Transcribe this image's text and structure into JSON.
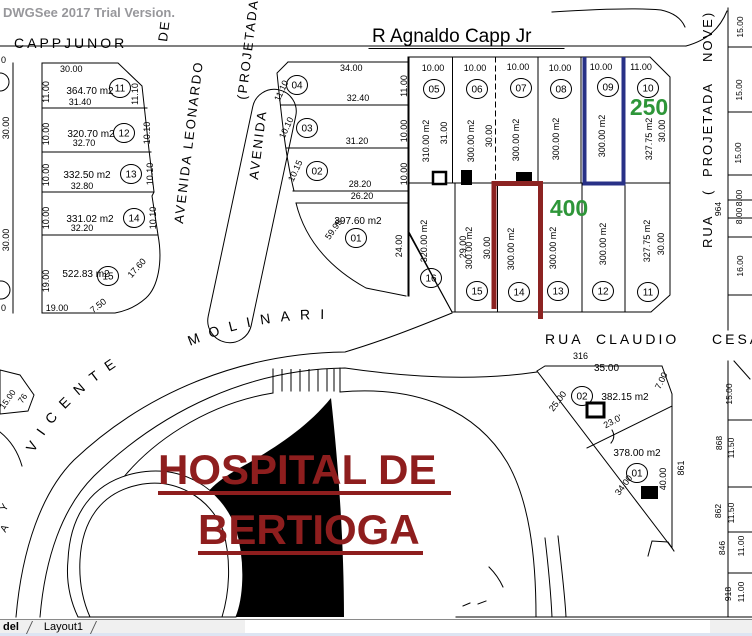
{
  "watermark": "DWGSee 2017 Trial Version.",
  "colors": {
    "highlight_blue": "#283187",
    "highlight_red": "#8C2322",
    "hospital_red": "#8E1E1E",
    "annotation_green": "#2E9639",
    "watermark_gray": "#97979b",
    "line_black": "#000000"
  },
  "tabs": {
    "model": "del",
    "layout1": "Layout1"
  },
  "streets": {
    "capp": "CAPP",
    "junor": "JUNOR",
    "agnaldo": "R Agnaldo Capp Jr",
    "de": "DE",
    "avenida_leonardo": "AVENIDA  LEONARDO",
    "avenida2": "AVENIDA",
    "projetada_paren": "(PROJETADA",
    "rua": "RUA",
    "claudio": "CLAUDIO",
    "cesar": "CESA",
    "rp_rua": "RUA",
    "rp_paren": "(",
    "rp_projetada": "PROJETADA",
    "rp_nove": "NOVE)",
    "vicente": "VICENTE",
    "molinari": "MOLINARI"
  },
  "hospital": {
    "line1": "HOSPITAL DE",
    "line2": "BERTIOGA"
  },
  "annotations": {
    "g250": "250",
    "g400": "400"
  },
  "blockA": {
    "top": "30.00",
    "side1": "30.00",
    "side2": "30.00",
    "zero1": "0",
    "zero2": "0",
    "lots": [
      {
        "n": "11",
        "area": "364.70 m2",
        "left": "11.00",
        "right": "11.10",
        "bottom": "31.40"
      },
      {
        "n": "12",
        "area": "320.70 m2",
        "left": "10.00",
        "right": "10.10",
        "bottom": "32.70"
      },
      {
        "n": "13",
        "area": "332.50 m2",
        "left": "10.00",
        "right": "10.10",
        "bottom": "32.80"
      },
      {
        "n": "14",
        "area": "331.02 m2",
        "left": "10.00",
        "right": "10.10",
        "bottom": "32.20"
      },
      {
        "n": "15",
        "area": "522.83 m2",
        "left": "19.00",
        "bottom": "19.00",
        "diag1": "7.50",
        "diag2": "17.60"
      }
    ]
  },
  "blockB": {
    "top": "34.00",
    "lots": [
      {
        "n": "04",
        "left": "11.10",
        "right": "11.00",
        "bottom": "32.40"
      },
      {
        "n": "03",
        "left": "10.10",
        "right": "10.00",
        "bottom": "31.20"
      },
      {
        "n": "02",
        "left": "10.15",
        "right": "10.00",
        "bottom": "28.20"
      },
      {
        "n": "01",
        "top": "26.20",
        "area": "397.60 m2",
        "right": "24.00",
        "curve": "59.95"
      }
    ]
  },
  "blockC": {
    "widths": [
      "10.00",
      "10.00",
      "10.00",
      "10.00",
      "10.00",
      "11.00"
    ],
    "top": [
      {
        "n": "05",
        "area": "310.00 m2",
        "dim": "31.00"
      },
      {
        "n": "06",
        "area": "300.00 m2",
        "dim": "30.00"
      },
      {
        "n": "07",
        "area": "300.00 m2"
      },
      {
        "n": "08",
        "area": "300.00 m2"
      },
      {
        "n": "09",
        "area": "300.00 m2"
      },
      {
        "n": "10",
        "area": "327.75 m2",
        "dim": "30.00"
      }
    ],
    "bottom": [
      {
        "n": "16",
        "area": "320.00 m2",
        "dim": "29.00"
      },
      {
        "n": "15",
        "area": "300.00 m2",
        "dim": "30.00"
      },
      {
        "n": "14",
        "area": "300.00 m2"
      },
      {
        "n": "13",
        "area": "300.00 m2"
      },
      {
        "n": "12",
        "area": "300.00 m2"
      },
      {
        "n": "11",
        "area": "327.75 m2",
        "dim": "30.00"
      }
    ]
  },
  "triangle": {
    "ref": "316",
    "top": "35.00",
    "side": "861",
    "lot02": {
      "n": "02",
      "area": "382.15 m2",
      "left": "25.00",
      "right": "7.00",
      "div": "23.0'"
    },
    "lot01": {
      "n": "01",
      "area": "378.00 m2",
      "hyp": "34.00",
      "right": "40.00"
    }
  },
  "rightStrip": {
    "u": [
      "15.00",
      "15.00",
      "15.00",
      "8.00",
      "8.00",
      "16.00"
    ],
    "ref964": "964",
    "l0": "15.00",
    "l1ref": "868",
    "l1": "11.50",
    "l2ref": "862",
    "l2": "11.50",
    "l3ref": "846",
    "l3": "11.00",
    "l4ref": "918",
    "l4": "11.00"
  },
  "leftEdge": {
    "dim": "15.00",
    "ref": "76",
    "y": "Y",
    "a": "A"
  }
}
